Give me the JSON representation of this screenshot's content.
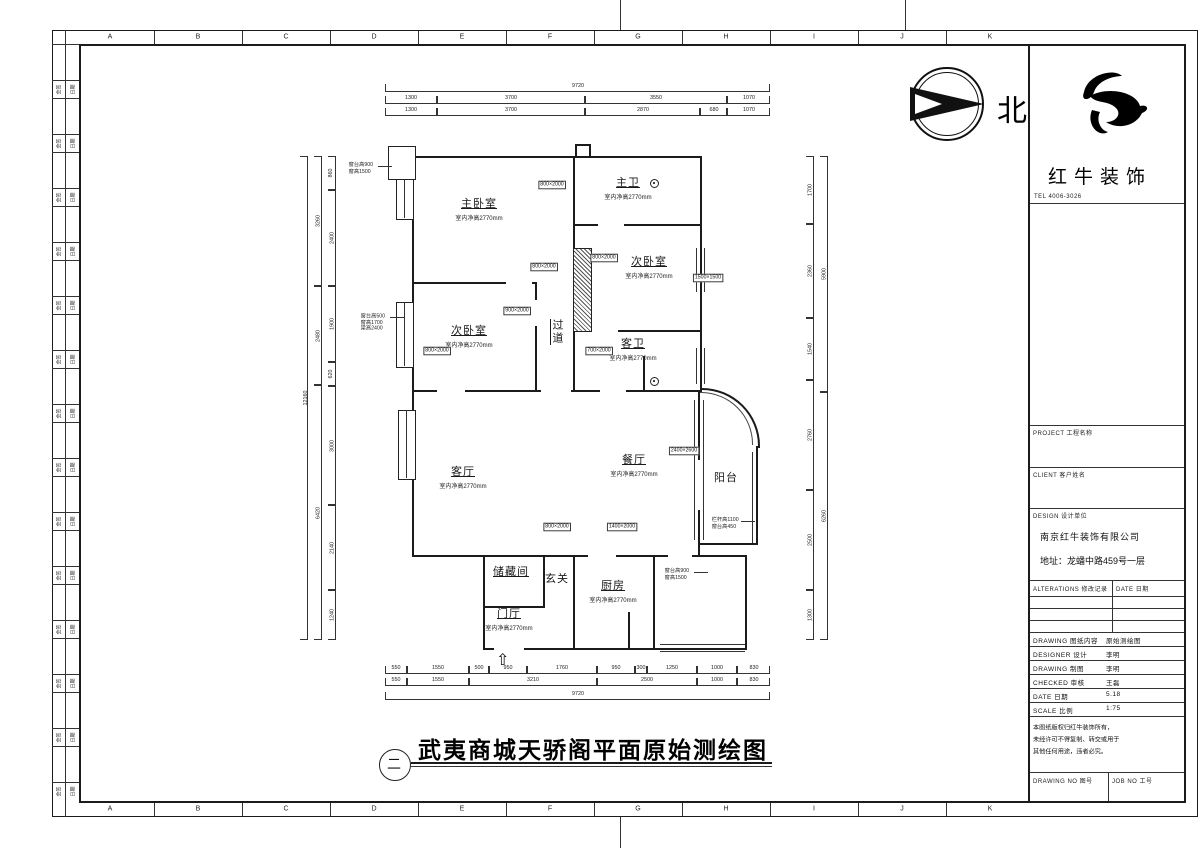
{
  "sheet": {
    "grid_letters": [
      "A",
      "B",
      "C",
      "D",
      "E",
      "F",
      "G",
      "H",
      "I",
      "J",
      "K"
    ],
    "binding": {
      "count": 14,
      "col1": "会签",
      "col2": "日期"
    }
  },
  "title_bar": {
    "index": "二",
    "title": "武夷商城天骄阁平面原始测绘图"
  },
  "north": {
    "label": "北"
  },
  "brand": {
    "name": "红牛装饰",
    "tel": "TEL 4006-3026"
  },
  "title_block": {
    "section1": "PROJECT 工程名称",
    "section2": "CLIENT 客户姓名",
    "design_header": "DESIGN 设计单位",
    "company": "南京红牛装饰有限公司",
    "address": "地址：龙蟠中路459号一层",
    "alterations": {
      "left": "ALTERATIONS 修改记录",
      "right": "DATE 日期"
    },
    "rows": [
      {
        "label": "DRAWING 图纸内容",
        "value": "原始测绘图"
      },
      {
        "label": "DESIGNER 设计",
        "value": "李明"
      },
      {
        "label": "DRAWING 制图",
        "value": "李明"
      },
      {
        "label": "CHECKED 审核",
        "value": "王磊"
      },
      {
        "label": "DATE 日期",
        "value": "5.18"
      },
      {
        "label": "SCALE 比例",
        "value": "1:75"
      }
    ],
    "notes": [
      "本图纸版权归红牛装饰所有，",
      "未经许可不得复制、转交或用于",
      "其他任何用途，违者必究。"
    ],
    "bottom": {
      "left": "DRAWING NO 图号",
      "right": "JOB NO 工号"
    }
  },
  "plan": {
    "entry_arrow": "⇧",
    "rooms": [
      {
        "name": "主卧室",
        "sub": "室内净高2770mm",
        "x": 479,
        "y": 203
      },
      {
        "name": "主卫",
        "sub": "室内净高2770mm",
        "x": 628,
        "y": 182
      },
      {
        "name": "次卧室",
        "sub": "室内净高2770mm",
        "x": 649,
        "y": 261
      },
      {
        "name": "次卧室",
        "sub": "室内净高2770mm",
        "x": 469,
        "y": 330
      },
      {
        "name": "客卫",
        "sub": "室内净高2770mm",
        "x": 633,
        "y": 343
      },
      {
        "name": "过道",
        "x": 557,
        "y": 332,
        "vertical": true
      },
      {
        "name": "客厅",
        "sub": "室内净高2770mm",
        "x": 463,
        "y": 471
      },
      {
        "name": "餐厅",
        "sub": "室内净高2770mm",
        "x": 634,
        "y": 459
      },
      {
        "name": "阳台",
        "x": 726,
        "y": 477,
        "plain": true
      },
      {
        "name": "厨房",
        "sub": "室内净高2770mm",
        "x": 613,
        "y": 585
      },
      {
        "name": "储藏间",
        "x": 511,
        "y": 571
      },
      {
        "name": "玄关",
        "x": 557,
        "y": 578,
        "plain": true
      },
      {
        "name": "门厅",
        "sub": "室内净高2770mm",
        "x": 509,
        "y": 613
      }
    ],
    "tags": [
      {
        "x": 552,
        "y": 185,
        "t": "800×2000"
      },
      {
        "x": 544,
        "y": 267,
        "t": "800×2000"
      },
      {
        "x": 604,
        "y": 258,
        "t": "800×2000"
      },
      {
        "x": 437,
        "y": 351,
        "t": "800×2000"
      },
      {
        "x": 599,
        "y": 351,
        "t": "700×2000"
      },
      {
        "x": 517,
        "y": 311,
        "t": "900×2000"
      },
      {
        "x": 557,
        "y": 527,
        "t": "800×2000"
      },
      {
        "x": 622,
        "y": 527,
        "t": "1400×2000"
      },
      {
        "x": 708,
        "y": 278,
        "t": "1500×1500"
      },
      {
        "x": 684,
        "y": 451,
        "t": "2400×2600"
      }
    ],
    "annotations": [
      {
        "x": 348,
        "y": 162,
        "lines": [
          "窗台高900",
          "窗高1500"
        ]
      },
      {
        "x": 360,
        "y": 313,
        "lines": [
          "窗台高500",
          "窗高1700",
          "梁高2400"
        ]
      },
      {
        "x": 664,
        "y": 568,
        "lines": [
          "窗台高900",
          "窗高1500"
        ]
      },
      {
        "x": 711,
        "y": 517,
        "lines": [
          "栏杆高1100",
          "窗台高450"
        ]
      }
    ]
  },
  "dims": {
    "top_x0": 385,
    "top": [
      {
        "y": 84,
        "segs": [
          {
            "w": 385,
            "t": "9720"
          }
        ]
      },
      {
        "y": 96,
        "segs": [
          {
            "w": 52,
            "t": "1300"
          },
          {
            "w": 148,
            "t": "3700"
          },
          {
            "w": 142,
            "t": "3550"
          },
          {
            "w": 43,
            "t": "1070"
          }
        ]
      },
      {
        "y": 108,
        "segs": [
          {
            "w": 52,
            "t": "1300"
          },
          {
            "w": 148,
            "t": "3700"
          },
          {
            "w": 115,
            "t": "2870"
          },
          {
            "w": 27,
            "t": "680"
          },
          {
            "w": 43,
            "t": "1070"
          }
        ]
      }
    ],
    "bottom": [
      {
        "y": 666,
        "segs": [
          {
            "w": 22,
            "t": "550"
          },
          {
            "w": 62,
            "t": "1550"
          },
          {
            "w": 20,
            "t": "500"
          },
          {
            "w": 38,
            "t": "950"
          },
          {
            "w": 70,
            "t": "1760"
          },
          {
            "w": 38,
            "t": "950"
          },
          {
            "w": 12,
            "t": "300"
          },
          {
            "w": 50,
            "t": "1250"
          },
          {
            "w": 40,
            "t": "1000"
          },
          {
            "w": 33,
            "t": "830"
          }
        ]
      },
      {
        "y": 678,
        "segs": [
          {
            "w": 22,
            "t": "550"
          },
          {
            "w": 62,
            "t": "1550"
          },
          {
            "w": 128,
            "t": "3210"
          },
          {
            "w": 100,
            "t": "2500"
          },
          {
            "w": 40,
            "t": "1000"
          },
          {
            "w": 33,
            "t": "830"
          }
        ]
      },
      {
        "y": 692,
        "segs": [
          {
            "w": 385,
            "t": "9720"
          }
        ]
      }
    ],
    "side_y0": 156,
    "left": [
      {
        "x": 300,
        "segs": [
          {
            "h": 484,
            "t": "12160"
          }
        ]
      },
      {
        "x": 314,
        "segs": [
          {
            "h": 130,
            "t": "3260"
          },
          {
            "h": 99,
            "t": "2480"
          },
          {
            "h": 255,
            "t": "6420"
          }
        ]
      },
      {
        "x": 328,
        "segs": [
          {
            "h": 34,
            "t": "860"
          },
          {
            "h": 96,
            "t": "2400"
          },
          {
            "h": 76,
            "t": "1900"
          },
          {
            "h": 24,
            "t": "620"
          },
          {
            "h": 119,
            "t": "3000"
          },
          {
            "h": 85,
            "t": "2140"
          },
          {
            "h": 50,
            "t": "1240"
          }
        ]
      }
    ],
    "right": [
      {
        "x": 806,
        "segs": [
          {
            "h": 68,
            "t": "1700"
          },
          {
            "h": 94,
            "t": "2360"
          },
          {
            "h": 62,
            "t": "1540"
          },
          {
            "h": 110,
            "t": "2760"
          },
          {
            "h": 100,
            "t": "2500"
          },
          {
            "h": 50,
            "t": "1300"
          }
        ]
      },
      {
        "x": 820,
        "segs": [
          {
            "h": 236,
            "t": "5900"
          },
          {
            "h": 248,
            "t": "6260"
          }
        ]
      }
    ]
  }
}
